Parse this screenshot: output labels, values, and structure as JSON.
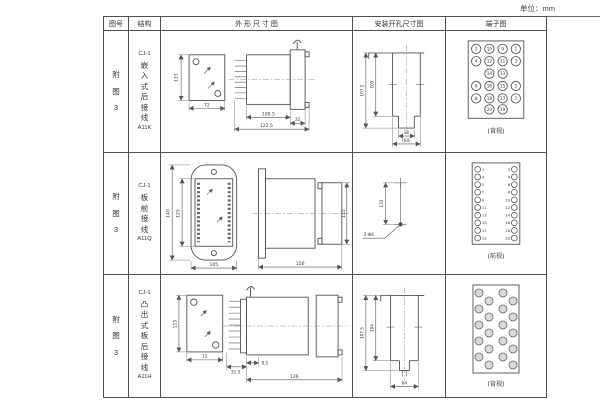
{
  "unit_label": "单位：mm",
  "header": {
    "figure": "图号",
    "structure": "结构",
    "outline": "外 形 尺 寸 图",
    "mounting": "安装开孔尺寸图",
    "terminal": "端子图"
  },
  "rows": [
    {
      "figure": "附图3",
      "structure": {
        "model": "CJ-1",
        "desc": "嵌入式后接线",
        "code": "A11K"
      },
      "outline": {
        "front_height": "115",
        "front_width": "72",
        "depth_body": "100.5",
        "depth_total": "122.5",
        "flange_depth": "35"
      },
      "mounting": {
        "height_outer": "107.5",
        "height_inner": "105",
        "notch_width": "16",
        "width_ref": "(64)"
      },
      "terminal": {
        "view_label": "(背视)",
        "rows": [
          [
            "2",
            "10",
            "9",
            "1"
          ],
          [
            "4",
            "12",
            "11",
            "3"
          ],
          [
            "14",
            "13"
          ],
          [
            "6",
            "16",
            "15",
            "5"
          ],
          [
            "8",
            "18",
            "17",
            "7"
          ],
          [
            "20",
            "19"
          ]
        ]
      }
    },
    {
      "figure": "附图3",
      "structure": {
        "model": "CJ-1",
        "desc": "板前接线",
        "code": "A11Q"
      },
      "outline": {
        "flange_height": "140",
        "body_height": "125",
        "flange_width": "105",
        "depth": "156",
        "side_height": "115"
      },
      "mounting": {
        "hole_distance": "133",
        "hole_spec": "2-Φ6"
      },
      "terminal": {
        "view_label": "(前视)",
        "left": [
          "1",
          "3",
          "5",
          "7",
          "9",
          "11",
          "13",
          "15",
          "17",
          "19"
        ],
        "right": [
          "2",
          "4",
          "6",
          "8",
          "10",
          "12",
          "14",
          "16",
          "18",
          "20"
        ]
      }
    },
    {
      "figure": "附图3",
      "structure": {
        "model": "CJ-1",
        "desc": "凸出式板后接线",
        "code": "A11H"
      },
      "outline": {
        "front_height": "115",
        "front_width": "72",
        "pin_depth": "31.5",
        "offset": "9.5",
        "depth": "126"
      },
      "mounting": {
        "height_outer": "107.5",
        "height_inner": "104",
        "width": "64"
      },
      "terminal": {
        "view_label": "(背视)"
      }
    }
  ]
}
